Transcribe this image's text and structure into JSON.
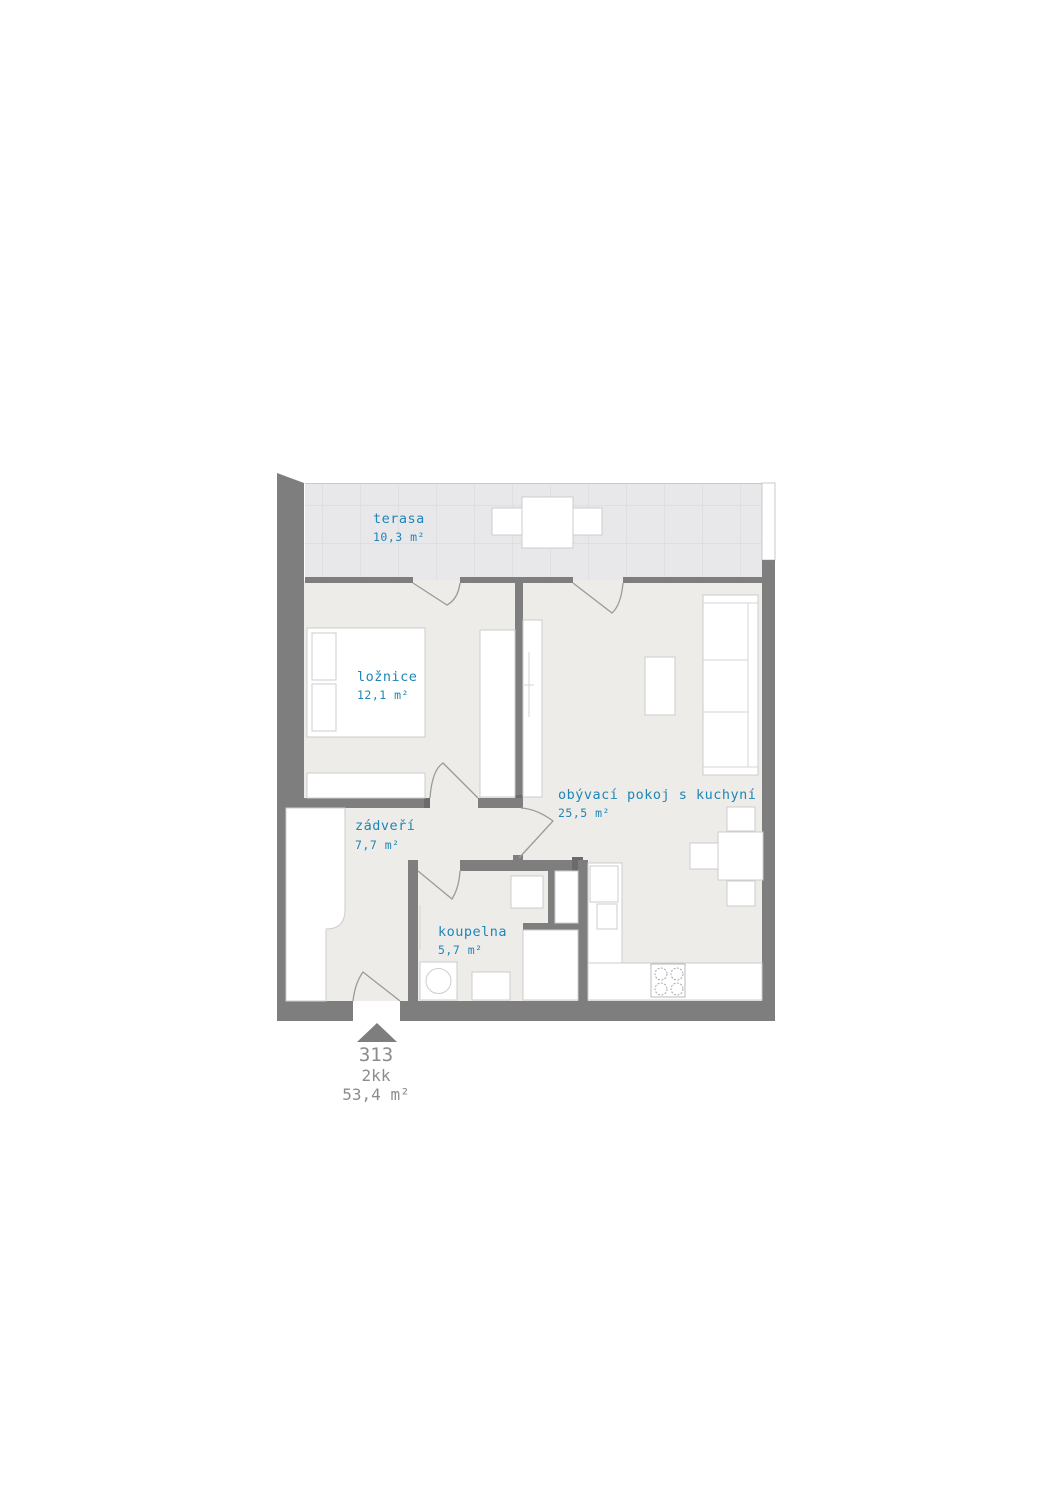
{
  "unit": {
    "number": "313",
    "layout": "2kk",
    "total_area": "53,4 m²"
  },
  "rooms": [
    {
      "id": "terasa",
      "name": "terasa",
      "area": "10,3 m²"
    },
    {
      "id": "loznice",
      "name": "ložnice",
      "area": "12,1 m²"
    },
    {
      "id": "zadveri",
      "name": "zádveří",
      "area": "7,7 m²"
    },
    {
      "id": "koupelna",
      "name": "koupelna",
      "area": "5,7 m²"
    },
    {
      "id": "obyvaci",
      "name": "obývací pokoj s kuchyní",
      "area": "25,5 m²"
    }
  ],
  "colors": {
    "room_label": "#1e86b8",
    "unit_label": "#8c8c8c",
    "wall": "#7e7e7e",
    "floor": "#eeece8",
    "terrace": "#e8e8ea"
  }
}
